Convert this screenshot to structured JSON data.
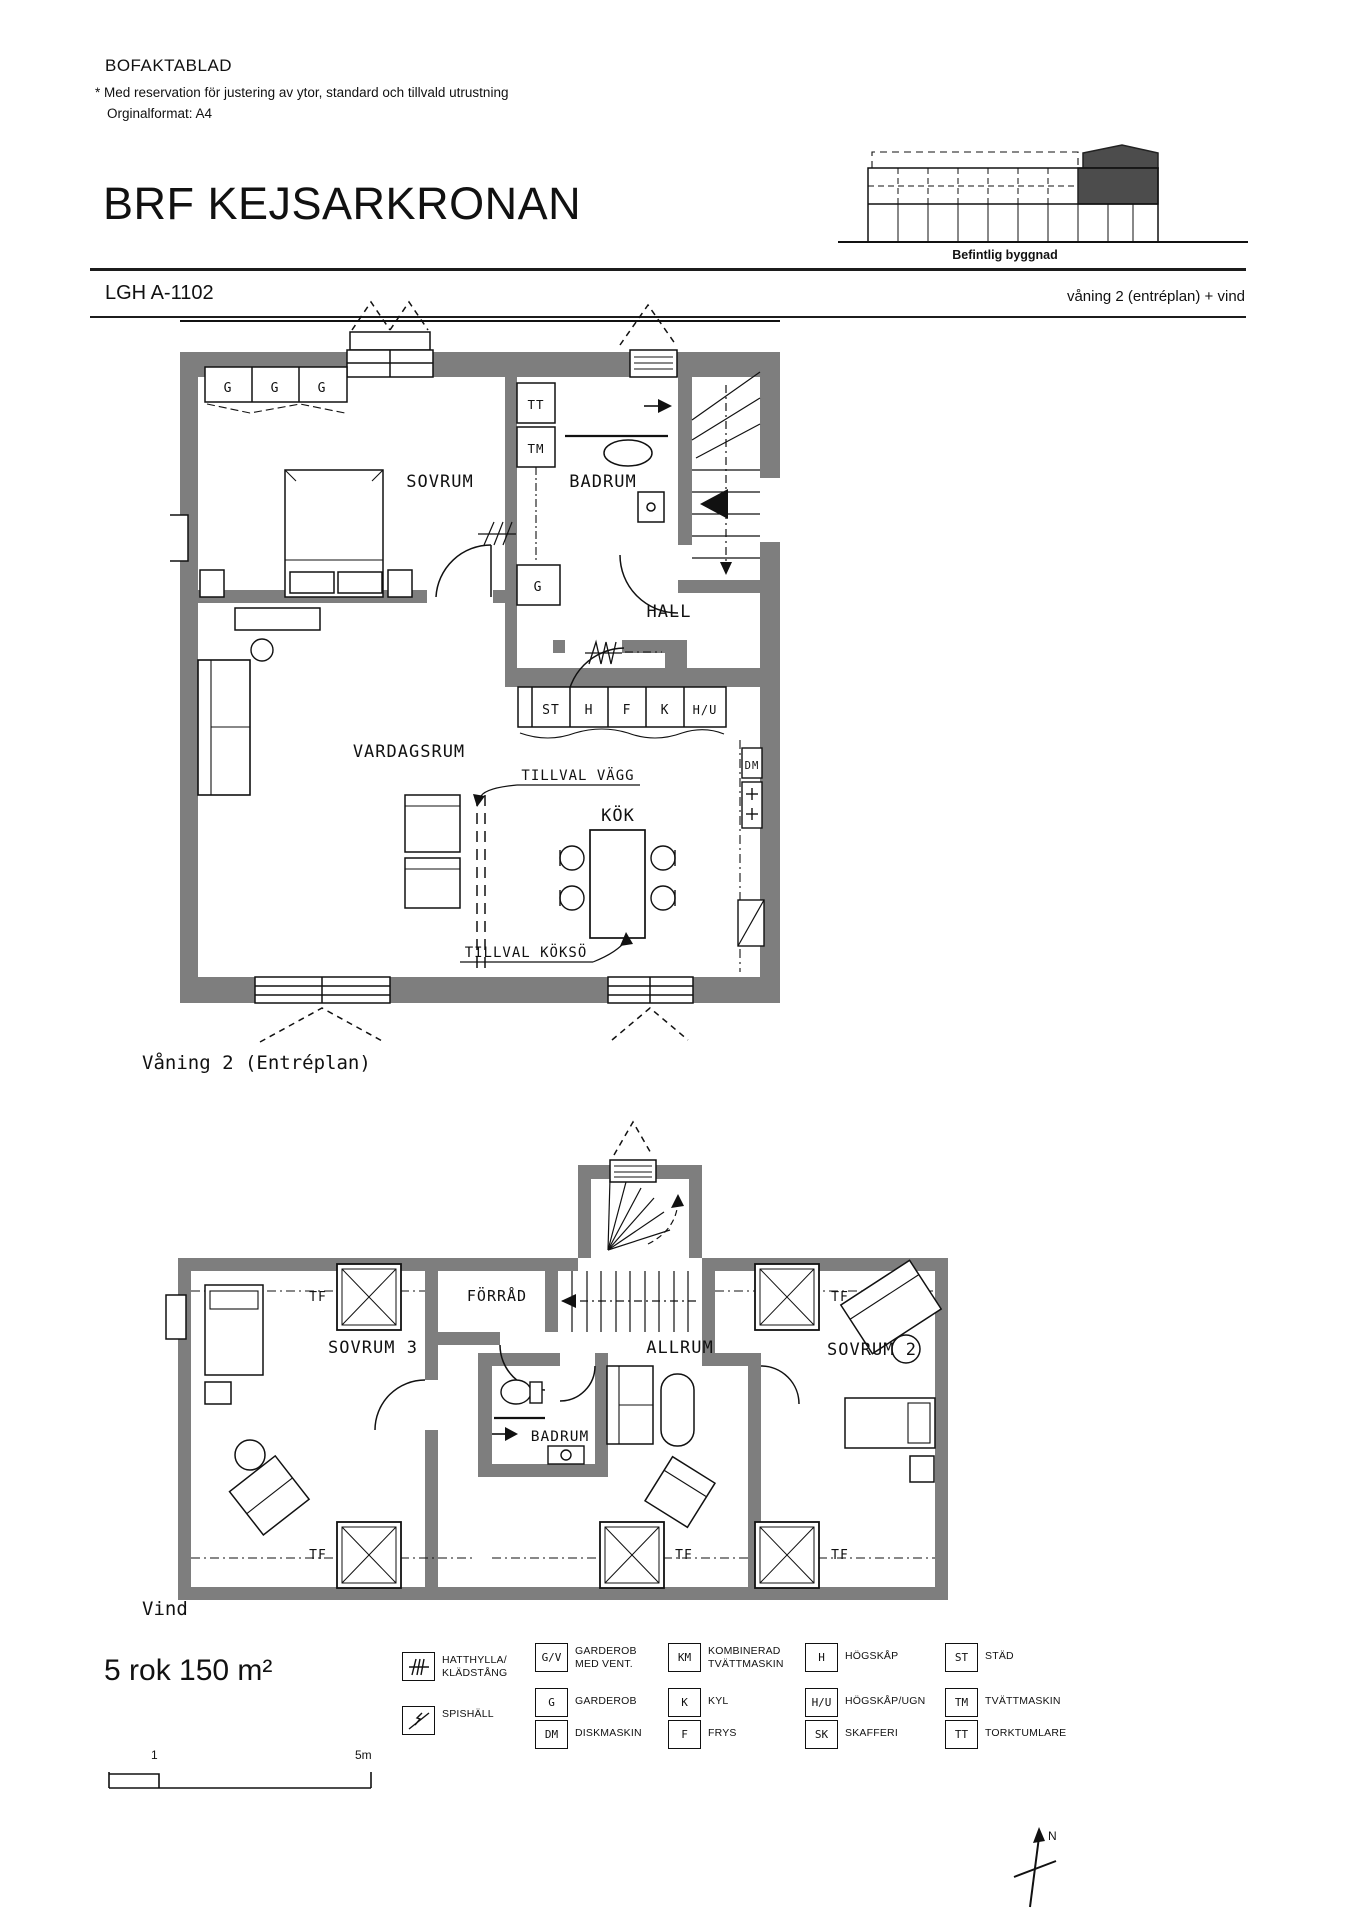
{
  "header": {
    "doc_type": "BOFAKTABLAD",
    "disclaimer": "* Med reservation för justering av ytor, standard och tillvald utrustning",
    "format_note": "Orginalformat: A4",
    "project_title": "BRF KEJSARKRONAN",
    "apartment_id": "LGH A-1102",
    "floor_note": "våning 2 (entréplan) + vind",
    "building_caption": "Befintlig byggnad"
  },
  "floor1": {
    "caption": "Våning 2 (Entréplan)",
    "rooms": {
      "sovrum": "SOVRUM",
      "badrum": "BADRUM",
      "hall": "HALL",
      "vardagsrum": "VARDAGSRUM",
      "kok": "KÖK"
    },
    "options": {
      "tillval_vagg": "TILLVAL VÄGG",
      "tillval_kokso": "TILLVAL KÖKSÖ"
    },
    "codes": {
      "g": "G",
      "tt": "TT",
      "tm": "TM",
      "st": "ST",
      "h": "H",
      "f": "F",
      "k": "K",
      "hu": "H/U",
      "dm": "DM"
    }
  },
  "floor2": {
    "caption": "Vind",
    "rooms": {
      "sovrum3": "SOVRUM 3",
      "forrad": "FÖRRÅD",
      "allrum": "ALLRUM",
      "sovrum2": "SOVRUM 2",
      "badrum": "BADRUM"
    },
    "codes": {
      "tf": "TF"
    }
  },
  "summary": {
    "size_text": "5 rok 150 m²"
  },
  "scale_bar": {
    "start_label": "1",
    "end_label": "5m"
  },
  "compass": {
    "label": "N"
  },
  "legend": {
    "icon_items": [
      {
        "icon": "hatthylla-icon",
        "line1": "HATTHYLLA/",
        "line2": "KLÄDSTÅNG"
      },
      {
        "icon": "spishall-icon",
        "line1": "SPISHÄLL",
        "line2": ""
      }
    ],
    "items": [
      {
        "code": "G/V",
        "line1": "GARDEROB",
        "line2": "MED VENT."
      },
      {
        "code": "G",
        "line1": "GARDEROB",
        "line2": ""
      },
      {
        "code": "DM",
        "line1": "DISKMASKIN",
        "line2": ""
      },
      {
        "code": "KM",
        "line1": "KOMBINERAD",
        "line2": "TVÄTTMASKIN"
      },
      {
        "code": "K",
        "line1": "KYL",
        "line2": ""
      },
      {
        "code": "F",
        "line1": "FRYS",
        "line2": ""
      },
      {
        "code": "H",
        "line1": "HÖGSKÅP",
        "line2": ""
      },
      {
        "code": "H/U",
        "line1": "HÖGSKÅP/UGN",
        "line2": ""
      },
      {
        "code": "SK",
        "line1": "SKAFFERI",
        "line2": ""
      },
      {
        "code": "ST",
        "line1": "STÄD",
        "line2": ""
      },
      {
        "code": "TM",
        "line1": "TVÄTTMASKIN",
        "line2": ""
      },
      {
        "code": "TT",
        "line1": "TORKTUMLARE",
        "line2": ""
      }
    ]
  }
}
